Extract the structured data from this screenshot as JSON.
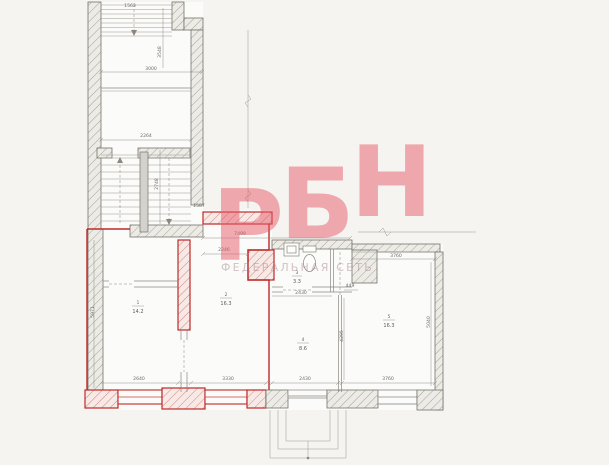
{
  "watermark": {
    "l1": "Р",
    "l2": "Б",
    "l3": "Н",
    "subtext": "ФЕДЕРАЛЬНАЯ СЕТЬ"
  },
  "colors": {
    "red": "#bf2a28",
    "line": "#8a877f",
    "wall_fill": "#edebe6",
    "watermark": "#e85a68",
    "background": "#f5f4f1"
  },
  "rooms": [
    {
      "num": "1",
      "area": "14.2"
    },
    {
      "num": "2",
      "area": "16.3"
    },
    {
      "num": "3",
      "area": "3.3"
    },
    {
      "num": "4",
      "area": "8.6"
    },
    {
      "num": "5",
      "area": "16.3"
    }
  ],
  "dims": {
    "top_flight": "1563",
    "top_w": "3000",
    "top_room_h": "3548",
    "lobby_w": "2264",
    "stair_door": "1587",
    "stair_h": "2748",
    "hall_w": "7499",
    "hall_w2": "2246",
    "pier_w": "449",
    "wing_top_w": "3760",
    "bath_w": "2430",
    "r1_w": "2640",
    "r2_w": "3330",
    "r3_w": "2430",
    "r4_w": "3760",
    "left_h": "5971",
    "mid_h": "4295",
    "right_h": "5040"
  }
}
